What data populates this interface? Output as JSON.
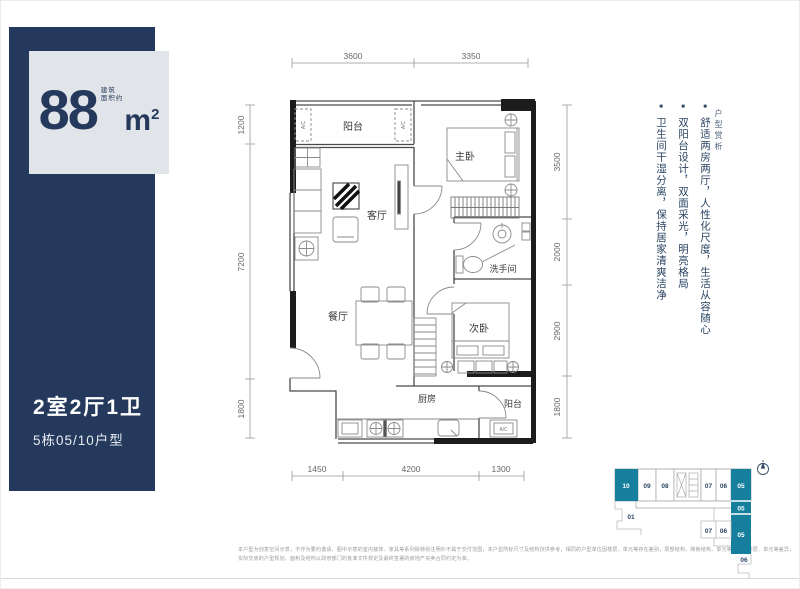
{
  "colors": {
    "navy": "#24395C",
    "panel_gray": "#E1E4E8",
    "teal": "#177F9E"
  },
  "left_panel": {
    "area_note_line1": "建筑",
    "area_note_line2": "面积约",
    "area_value": "88",
    "area_unit": "m",
    "area_sup": "2",
    "layout_title": "2室2厅1卫",
    "unit_subtitle": "5栋05/10户型"
  },
  "floor_plan": {
    "ac_label": "A/C",
    "rooms": {
      "balcony_top": "阳台",
      "master_bedroom": "主卧",
      "living_room": "客厅",
      "bathroom": "洗手间",
      "dining_room": "餐厅",
      "second_bedroom": "次卧",
      "kitchen": "厨房",
      "balcony_bottom": "阳台"
    },
    "dimensions": {
      "top": [
        "3600",
        "3350"
      ],
      "left": [
        "1200",
        "7200",
        "1800"
      ],
      "right": [
        "3500",
        "2000",
        "2900",
        "1800"
      ],
      "bottom": [
        "1450",
        "4200",
        "1300"
      ]
    }
  },
  "highlights": {
    "section_label": "户型赏析",
    "bullet_char": "■",
    "bullets": [
      "舒适两房两厅，人性化尺度，生活从容随心",
      "双阳台设计，双面采光，明亮格局",
      "卫生间干湿分离，保持居家清爽洁净"
    ]
  },
  "key_plan": {
    "bar_units": [
      "10",
      "09",
      "08",
      "07",
      "06"
    ],
    "stack_labels": [
      "05",
      "05",
      "05"
    ],
    "mid_units": [
      "07",
      "06"
    ],
    "left_unit": "01",
    "bottom_unit": "06"
  },
  "disclaimer": {
    "line1": "本户型为创意空间示意，不作为要约邀请，图中示意的室内装饰、家具等系列除特别注明外不属于交付范围，本户型所标尺寸及结构仅供参考，相同的户型单位因楼层、单元等存在差别，局部结构、降板结构、单元等存在因楼层、单元等差异，",
    "line2": "实际交房的户型规划、面积及结构以政府部门的批准文件规定及最终签署的房地产买卖合同约定为准。"
  }
}
